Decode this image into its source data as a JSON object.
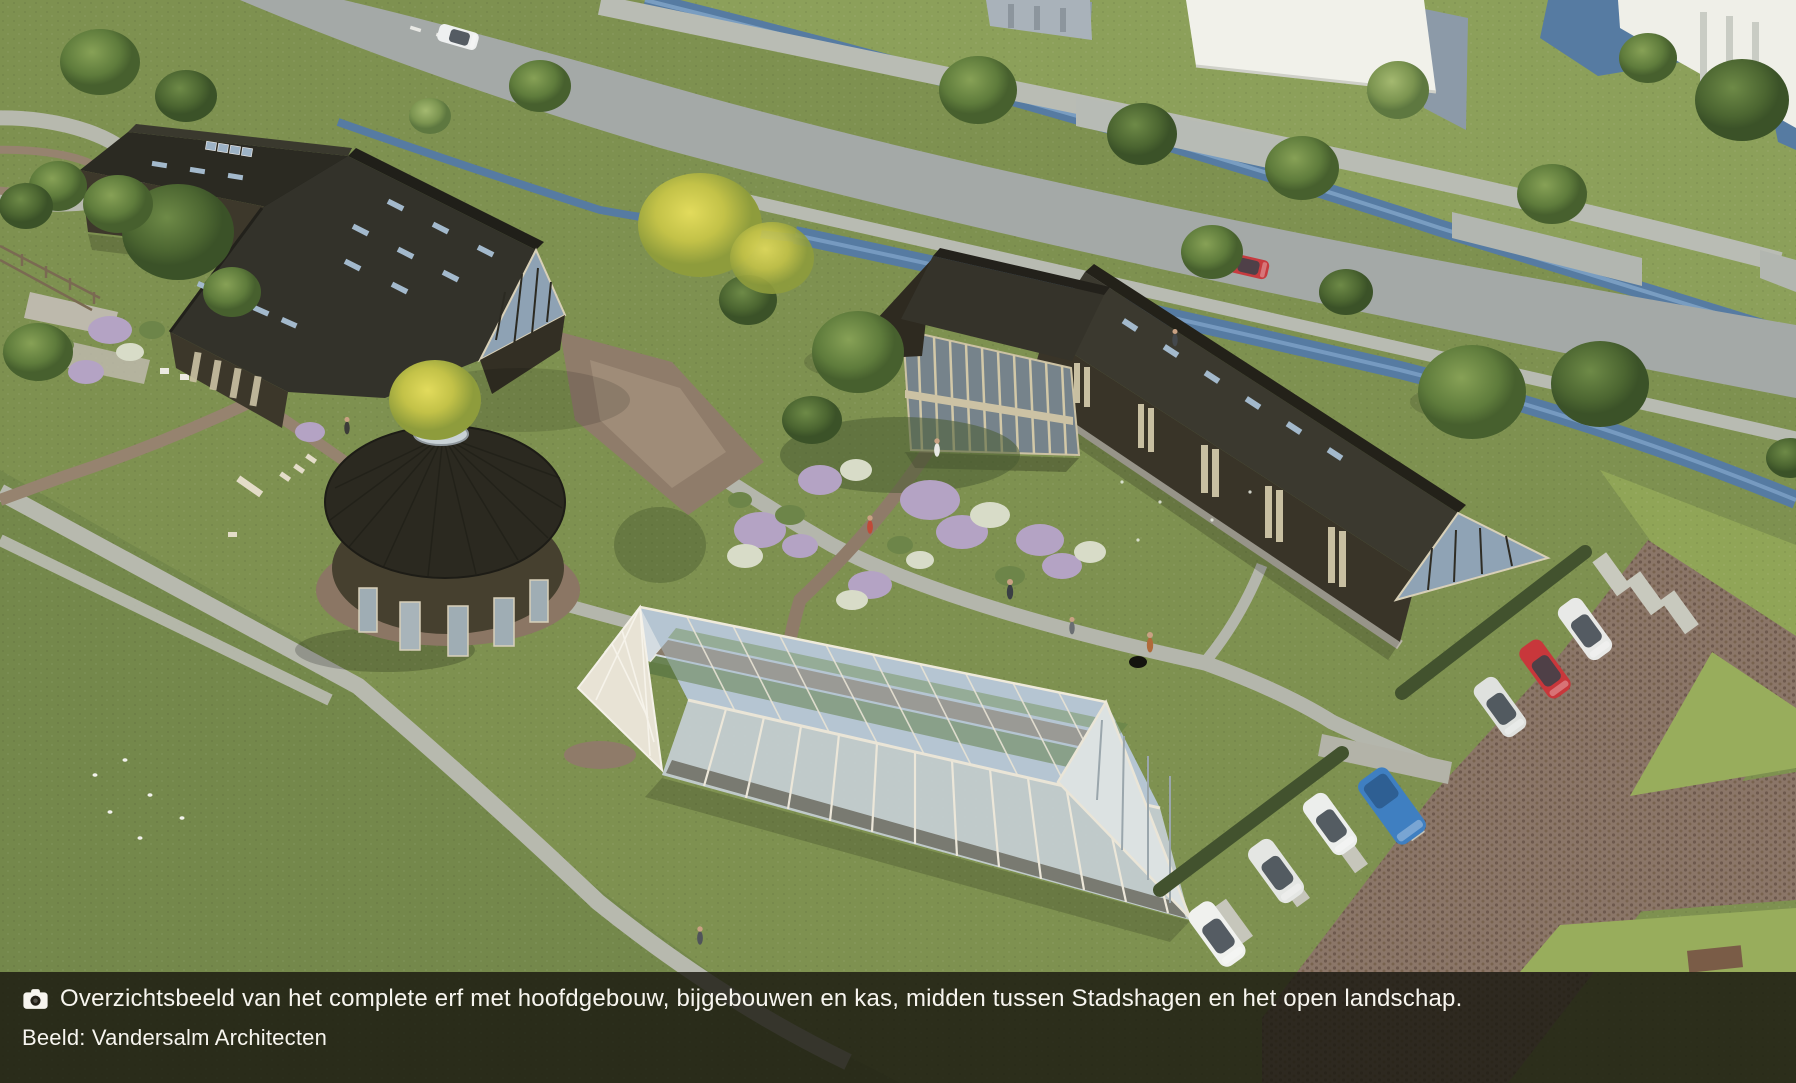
{
  "caption": {
    "icon": "camera-icon",
    "text": "Overzichtsbeeld van het complete erf met hoofdgebouw, bijgebouwen en kas, midden tussen Stadshagen en het open landschap.",
    "credit": "Beeld: Vandersalm Architecten"
  },
  "palette": {
    "grass": "#7E9150",
    "dark_roof": "#2B2A22",
    "water": "#567BA2",
    "road": "#A4A9A7",
    "brick_path": "#8B7668",
    "greenhouse_frame": "#EAE5D7",
    "car_red": "#C8373B",
    "car_blue": "#3F7FC1",
    "caption_background": "rgba(26,25,16,0.82)",
    "caption_text": "#F7F5EF"
  }
}
